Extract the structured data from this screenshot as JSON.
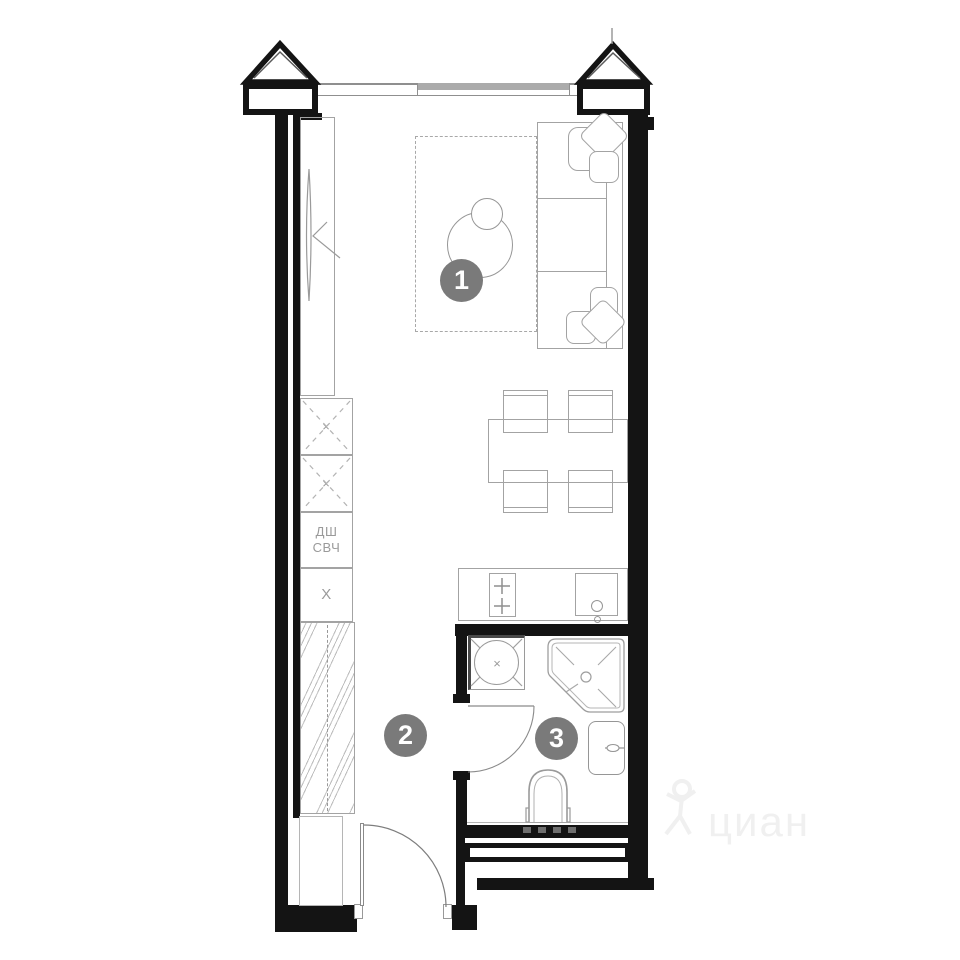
{
  "labels": {
    "room1_number": "1",
    "room2_number": "2",
    "room3_number": "3",
    "oven_abbr": "ДШ",
    "microwave_abbr": "СВЧ",
    "fridge_abbr": "Х",
    "cabinet1_cross": "×",
    "cabinet2_cross": "×",
    "washer_cross": "×"
  },
  "watermark": {
    "text": "циан"
  },
  "colors": {
    "wall": "#141414",
    "furniture_line": "#a3a3a3",
    "badge": "#7a7a7a",
    "label_text": "#9a9a9a",
    "watermark": "#f0f0f0"
  },
  "floorplan": {
    "type": "studio-apartment-plan",
    "rooms": [
      {
        "number": "1",
        "name": "living-area"
      },
      {
        "number": "2",
        "name": "hallway"
      },
      {
        "number": "3",
        "name": "bathroom"
      }
    ],
    "fixtures": [
      "tv-unit",
      "rug",
      "coffee-table",
      "sofa",
      "dining-table",
      "chairs",
      "tall-cabinets",
      "oven-microwave-column",
      "fridge",
      "wardrobe",
      "kitchen-counter",
      "hob",
      "kitchen-sink",
      "washing-machine",
      "shower",
      "bathroom-sink",
      "toilet",
      "entrance-door",
      "bathroom-door",
      "window",
      "balcony-corner-piers",
      "vent-duct"
    ]
  }
}
